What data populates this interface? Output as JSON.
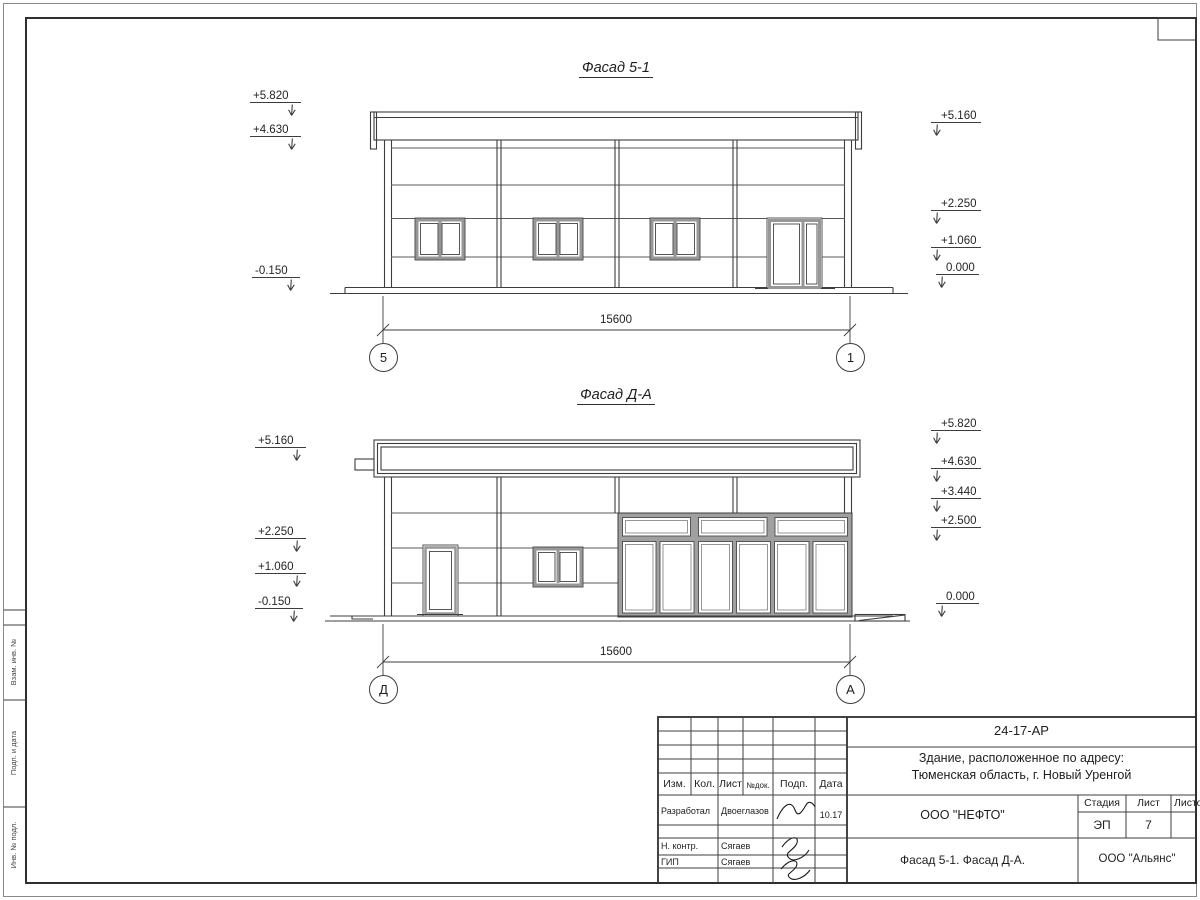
{
  "facade_top": {
    "title": "Фасад 5-1",
    "left_marks": [
      "+5.820",
      "+4.630",
      "-0.150"
    ],
    "right_marks": [
      "+5.160",
      "+2.250",
      "+1.060",
      "0.000"
    ],
    "dimension": "15600",
    "axis_left": "5",
    "axis_right": "1"
  },
  "facade_bottom": {
    "title": "Фасад Д-А",
    "left_marks": [
      "+5.160",
      "+2.250",
      "+1.060",
      "-0.150"
    ],
    "right_marks": [
      "+5.820",
      "+4.630",
      "+3.440",
      "+2.500",
      "0.000"
    ],
    "dimension": "15600",
    "axis_left": "Д",
    "axis_right": "А"
  },
  "title_block": {
    "doc_code": "24-17-АР",
    "object_line1": "Здание, расположенное по адресу:",
    "object_line2": "Тюменская область, г. Новый Уренгой",
    "col_izm": "Изм.",
    "col_kol": "Кол.",
    "col_list": "Лист",
    "col_ndoc": "№док.",
    "col_podp": "Подп.",
    "col_data": "Дата",
    "row1_role": "Разработал",
    "row1_name": "Двоеглазов",
    "row1_date": "10.17",
    "row2_role": "Н. контр.",
    "row2_name": "Сягаев",
    "row3_role": "ГИП",
    "row3_name": "Сягаев",
    "company": "ООО \"НЕФТО\"",
    "stage_label": "Стадия",
    "sheet_label": "Лист",
    "sheets_label": "Листов",
    "stage_value": "ЭП",
    "sheet_value": "7",
    "drawing_title": "Фасад 5-1. Фасад Д-А.",
    "firm": "ООО \"Альянс\""
  },
  "side_strip": {
    "label1": "Взам. инв. №",
    "label2": "Подп. и дата",
    "label3": "Инв. № подл."
  },
  "colors": {
    "line": "#3d3d3d",
    "frame_gray": "#979797"
  }
}
